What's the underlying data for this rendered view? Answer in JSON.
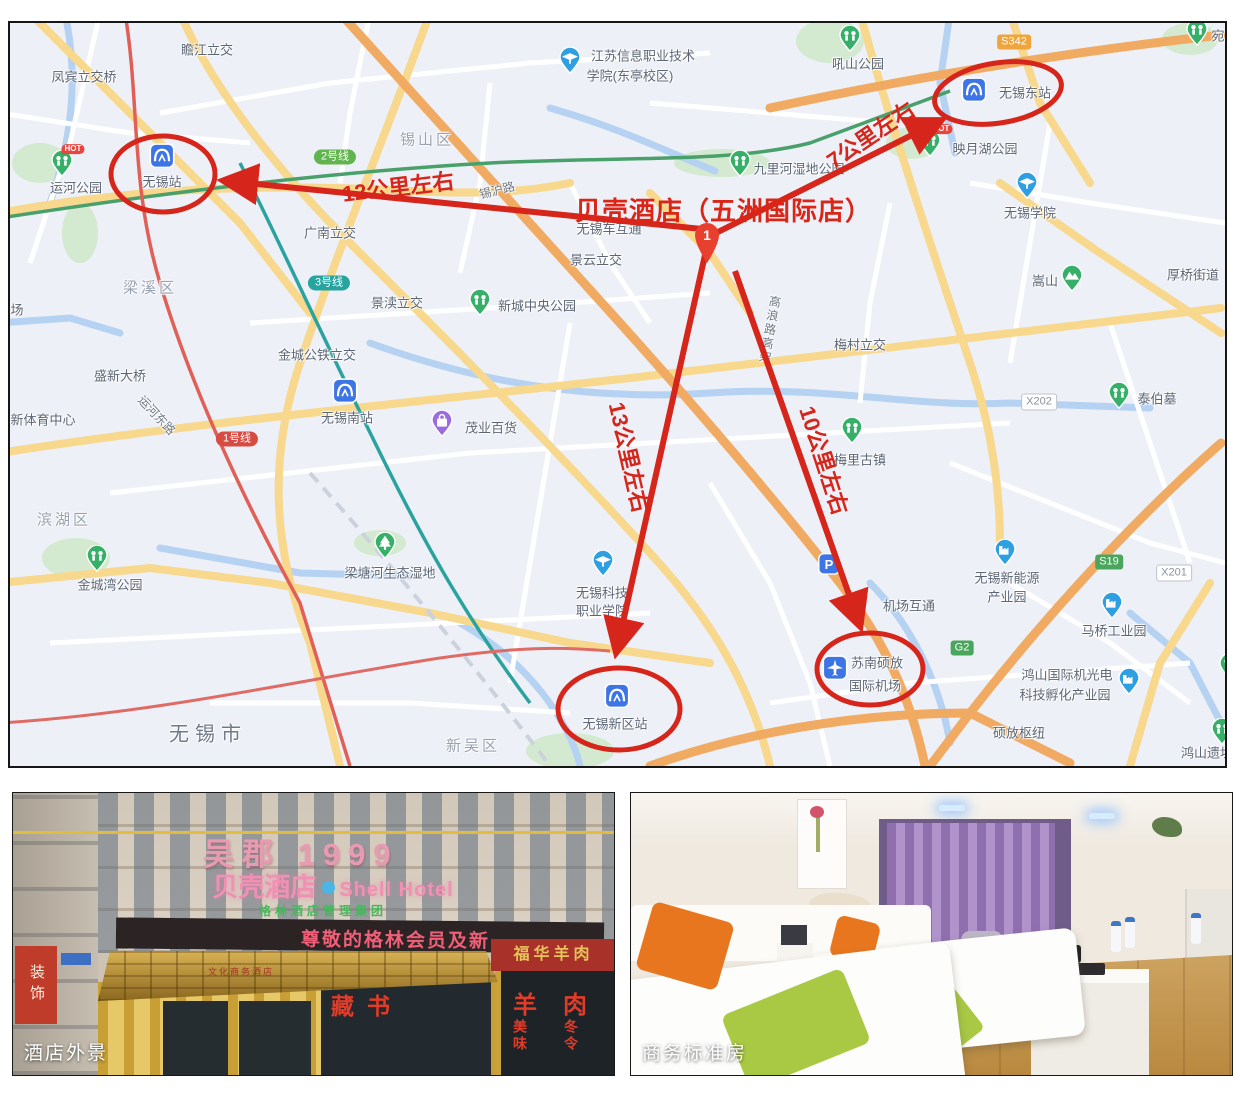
{
  "colors": {
    "annotation_red": "#d6251a",
    "map_bg": "#edf0f7",
    "led_pink": "#ef5f78",
    "brand_pink": "#f090b2"
  },
  "map": {
    "city": {
      "t": "无锡市",
      "x": 198,
      "y": 709
    },
    "districts": [
      {
        "t": "锡山区",
        "x": 417,
        "y": 116
      },
      {
        "t": "梁溪区",
        "x": 140,
        "y": 264
      },
      {
        "t": "滨湖区",
        "x": 54,
        "y": 496
      },
      {
        "t": "新吴区",
        "x": 463,
        "y": 722
      }
    ],
    "interchanges": [
      {
        "t": "瞻江立交",
        "x": 197,
        "y": 26
      },
      {
        "t": "凤宾立交桥",
        "x": 74,
        "y": 53
      },
      {
        "t": "广南立交",
        "x": 320,
        "y": 209
      },
      {
        "t": "景云立交",
        "x": 586,
        "y": 236
      },
      {
        "t": "景渎立交",
        "x": 387,
        "y": 279
      },
      {
        "t": "金城公铁立交",
        "x": 307,
        "y": 331
      },
      {
        "t": "盛新大桥",
        "x": 110,
        "y": 352
      },
      {
        "t": "新体育中心",
        "x": 33,
        "y": 396
      },
      {
        "t": "无锡车互通",
        "x": 599,
        "y": 205
      },
      {
        "t": "梅村立交",
        "x": 850,
        "y": 321
      },
      {
        "t": "厚桥街道",
        "x": 1183,
        "y": 251
      },
      {
        "t": "机场互通",
        "x": 899,
        "y": 582
      },
      {
        "t": "硕放枢纽",
        "x": 1009,
        "y": 709
      },
      {
        "t": "场",
        "x": 7,
        "y": 286
      }
    ],
    "road_names": [
      {
        "t": "锡沪路",
        "x": 487,
        "y": 167,
        "rot": -14
      },
      {
        "t": "运河东路",
        "x": 147,
        "y": 392,
        "rot": 47
      },
      {
        "t": "高浪路高架",
        "x": 760,
        "y": 272,
        "vertical": true
      }
    ],
    "transit_badges": [
      {
        "t": "2号线",
        "x": 325,
        "y": 134,
        "s": "line-green"
      },
      {
        "t": "3号线",
        "x": 319,
        "y": 260,
        "s": "line-teal"
      },
      {
        "t": "1号线",
        "x": 227,
        "y": 416,
        "s": "line-red"
      },
      {
        "t": "S342",
        "x": 1004,
        "y": 19,
        "s": "road-orange"
      },
      {
        "t": "S19",
        "x": 1099,
        "y": 539,
        "s": "road-green"
      },
      {
        "t": "G2",
        "x": 952,
        "y": 625,
        "s": "road-green"
      },
      {
        "t": "X202",
        "x": 1029,
        "y": 379,
        "s": "road-white"
      },
      {
        "t": "X201",
        "x": 1164,
        "y": 550,
        "s": "road-white"
      }
    ],
    "pois": [
      {
        "icon": "park",
        "ix": 52,
        "iy": 142,
        "hot": true,
        "labels": [
          {
            "t": "运河公园",
            "x": 66,
            "y": 164
          }
        ]
      },
      {
        "icon": "park",
        "ix": 840,
        "iy": 17,
        "labels": [
          {
            "t": "吼山公园",
            "x": 848,
            "y": 40
          }
        ]
      },
      {
        "icon": "park",
        "ix": 1187,
        "iy": 11,
        "labels": [
          {
            "t": "宛",
            "x": 1208,
            "y": 12
          }
        ]
      },
      {
        "icon": "school",
        "ix": 560,
        "iy": 39,
        "labels": [
          {
            "t": "江苏信息职业技术",
            "x": 633,
            "y": 32
          },
          {
            "t": "学院(东亭校区)",
            "x": 620,
            "y": 52
          }
        ]
      },
      {
        "icon": "park",
        "ix": 730,
        "iy": 142,
        "labels": [
          {
            "t": "九里河湿地公园",
            "x": 789,
            "y": 145
          }
        ]
      },
      {
        "icon": "park",
        "ix": 920,
        "iy": 122,
        "hot": true,
        "labels": [
          {
            "t": "映月湖公园",
            "x": 975,
            "y": 125
          }
        ]
      },
      {
        "icon": "school",
        "ix": 1017,
        "iy": 164,
        "labels": [
          {
            "t": "无锡学院",
            "x": 1020,
            "y": 189
          }
        ]
      },
      {
        "icon": "metro",
        "ix": 152,
        "iy": 134,
        "labels": [
          {
            "t": "无锡站",
            "x": 152,
            "y": 158
          }
        ]
      },
      {
        "icon": "metro",
        "ix": 964,
        "iy": 68,
        "labels": [
          {
            "t": "无锡东站",
            "x": 1015,
            "y": 69
          }
        ]
      },
      {
        "icon": "metro",
        "ix": 335,
        "iy": 369,
        "labels": [
          {
            "t": "无锡南站",
            "x": 337,
            "y": 394
          }
        ]
      },
      {
        "icon": "metro",
        "ix": 607,
        "iy": 674,
        "labels": [
          {
            "t": "无锡新区站",
            "x": 605,
            "y": 700
          }
        ]
      },
      {
        "icon": "park",
        "ix": 470,
        "iy": 281,
        "labels": [
          {
            "t": "新城中央公园",
            "x": 527,
            "y": 282
          }
        ]
      },
      {
        "icon": "shop",
        "ix": 432,
        "iy": 402,
        "labels": [
          {
            "t": "茂业百货",
            "x": 481,
            "y": 404
          }
        ]
      },
      {
        "icon": "tree",
        "ix": 375,
        "iy": 524,
        "labels": [
          {
            "t": "梁塘河生态湿地",
            "x": 380,
            "y": 549
          }
        ]
      },
      {
        "icon": "park",
        "ix": 87,
        "iy": 537,
        "labels": [
          {
            "t": "金城湾公园",
            "x": 100,
            "y": 561
          }
        ]
      },
      {
        "icon": "school",
        "ix": 593,
        "iy": 542,
        "labels": [
          {
            "t": "无锡科技",
            "x": 592,
            "y": 569
          },
          {
            "t": "职业学院",
            "x": 592,
            "y": 587
          }
        ]
      },
      {
        "icon": "mountain",
        "ix": 1062,
        "iy": 257,
        "labels": [
          {
            "t": "嵩山",
            "x": 1035,
            "y": 257
          }
        ]
      },
      {
        "icon": "park",
        "ix": 1109,
        "iy": 374,
        "labels": [
          {
            "t": "泰伯墓",
            "x": 1147,
            "y": 375
          }
        ]
      },
      {
        "icon": "park",
        "ix": 842,
        "iy": 409,
        "labels": [
          {
            "t": "梅里古镇",
            "x": 850,
            "y": 436
          }
        ]
      },
      {
        "icon": "airport",
        "ix": 825,
        "iy": 646,
        "labels": [
          {
            "t": "苏南硕放",
            "x": 867,
            "y": 639
          },
          {
            "t": "国际机场",
            "x": 865,
            "y": 662
          }
        ]
      },
      {
        "icon": "factory",
        "ix": 995,
        "iy": 531,
        "labels": [
          {
            "t": "无锡新能源",
            "x": 997,
            "y": 554
          },
          {
            "t": "产业园",
            "x": 997,
            "y": 573
          }
        ]
      },
      {
        "icon": "factory",
        "ix": 1102,
        "iy": 584,
        "labels": [
          {
            "t": "马桥工业园",
            "x": 1104,
            "y": 607
          }
        ]
      },
      {
        "icon": "factory",
        "ix": 1119,
        "iy": 660,
        "labels": [
          {
            "t": "鸿山国际机光电",
            "x": 1057,
            "y": 651
          },
          {
            "t": "科技孵化产业园",
            "x": 1055,
            "y": 671
          }
        ]
      },
      {
        "icon": "park",
        "ix": 1212,
        "iy": 710,
        "labels": [
          {
            "t": "鸿山遗址",
            "x": 1197,
            "y": 729
          }
        ]
      },
      {
        "icon": "parking",
        "ix": 819,
        "iy": 542,
        "labels": []
      },
      {
        "icon": "park",
        "ix": 1220,
        "iy": 645,
        "labels": []
      }
    ]
  },
  "annotations": {
    "hotel_title": "贝壳酒店（五洲国际店）",
    "marker_number": "1",
    "arrows": [
      {
        "label": "12公里左右",
        "x1": 702,
        "y1": 207,
        "x2": 217,
        "y2": 158,
        "lx": 388,
        "ly": 163,
        "rot": -7
      },
      {
        "label": "7公里左右",
        "x1": 702,
        "y1": 212,
        "x2": 928,
        "y2": 99,
        "lx": 860,
        "ly": 111,
        "rot": -34
      },
      {
        "label": "13公里左右",
        "x1": 695,
        "y1": 232,
        "x2": 607,
        "y2": 626,
        "lx": 620,
        "ly": 434,
        "rot": 77
      },
      {
        "label": "10公里左右",
        "x1": 725,
        "y1": 248,
        "x2": 849,
        "y2": 600,
        "lx": 815,
        "ly": 437,
        "rot": 72
      }
    ],
    "ellipses": [
      {
        "cx": 153,
        "cy": 151,
        "rx": 52,
        "ry": 38,
        "rot": 0
      },
      {
        "cx": 988,
        "cy": 70,
        "rx": 64,
        "ry": 30,
        "rot": -9
      },
      {
        "cx": 860,
        "cy": 646,
        "rx": 53,
        "ry": 36,
        "rot": 0
      },
      {
        "cx": 609,
        "cy": 686,
        "rx": 61,
        "ry": 41,
        "rot": 0
      }
    ]
  },
  "photos": {
    "left": {
      "caption": "酒店外景",
      "roof_sign": "吴郡 1999",
      "brand_cn": "贝壳酒店",
      "brand_en": "Shell Hotel",
      "group_line": "格林酒店管理集团",
      "led_text": "尊敬的格林会员及新",
      "canopy_text": "文化商务酒店",
      "side_banner": "装饰",
      "decals": {
        "book": "藏书",
        "meat": "羊肉",
        "v1": "美味",
        "v2": "冬令",
        "corner": "福华羊肉"
      }
    },
    "right": {
      "caption": "商务标准房"
    }
  }
}
